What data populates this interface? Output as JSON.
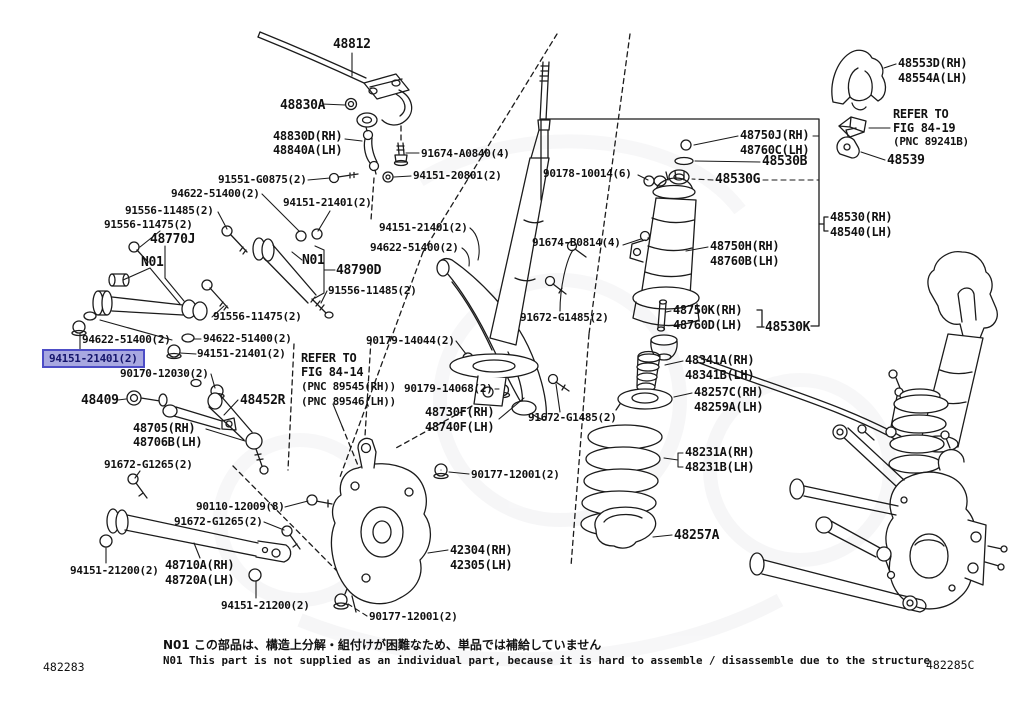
{
  "diagram": {
    "title": "Rear suspension parts diagram",
    "figure_code_left": "482283",
    "figure_code_right": "482285C",
    "note_jp": "N01 この部品は、構造上分解・組付けが困難なため、単品では補給していません",
    "note_en": "N01 This part is not supplied as an individual part, because it is hard to assemble / disassemble due to the structure",
    "selected_part": "94151-21401(2)"
  },
  "colors": {
    "line": "#1b1b1b",
    "highlight_fill": "#a8a8e0",
    "highlight_border": "#4d4dc6",
    "highlight_text": "#15156b"
  },
  "labels": [
    {
      "t": "48812",
      "x": 333,
      "y": 38
    },
    {
      "t": "48830A",
      "x": 280,
      "y": 99
    },
    {
      "t": "48830D(RH)",
      "x": 273,
      "y": 130
    },
    {
      "t": "48840A(LH)",
      "x": 273,
      "y": 144
    },
    {
      "t": "91674-A0840(4)",
      "x": 421,
      "y": 148
    },
    {
      "t": "91551-G0875(2)",
      "x": 218,
      "y": 174
    },
    {
      "t": "94151-20801(2)",
      "x": 413,
      "y": 170
    },
    {
      "t": "94622-51400(2)",
      "x": 171,
      "y": 188
    },
    {
      "t": "94151-21401(2)",
      "x": 283,
      "y": 197
    },
    {
      "t": "91556-11485(2)",
      "x": 125,
      "y": 205
    },
    {
      "t": "91556-11475(2)",
      "x": 104,
      "y": 219
    },
    {
      "t": "48770J",
      "x": 150,
      "y": 233
    },
    {
      "t": "N01",
      "x": 141,
      "y": 256
    },
    {
      "t": "94151-21401(2)",
      "x": 379,
      "y": 222
    },
    {
      "t": "94622-51400(2)",
      "x": 370,
      "y": 242
    },
    {
      "t": "N01",
      "x": 302,
      "y": 254
    },
    {
      "t": "48790D",
      "x": 336,
      "y": 264
    },
    {
      "t": "91556-11485(2)",
      "x": 328,
      "y": 285
    },
    {
      "t": "91556-11475(2)",
      "x": 213,
      "y": 311
    },
    {
      "t": "94622-51400(2)",
      "x": 82,
      "y": 334
    },
    {
      "t": "94151-21401(2)",
      "x": 50,
      "y": 354,
      "hl": true
    },
    {
      "t": "94622-51400(2)",
      "x": 203,
      "y": 333
    },
    {
      "t": "94151-21401(2)",
      "x": 197,
      "y": 348
    },
    {
      "t": "90170-12030(2)",
      "x": 120,
      "y": 368
    },
    {
      "t": "48409",
      "x": 81,
      "y": 394
    },
    {
      "t": "48452R",
      "x": 240,
      "y": 394
    },
    {
      "t": "48705(RH)",
      "x": 133,
      "y": 422
    },
    {
      "t": "48706B(LH)",
      "x": 133,
      "y": 436
    },
    {
      "t": "91672-G1265(2)",
      "x": 104,
      "y": 459
    },
    {
      "t": "90110-12009(8)",
      "x": 196,
      "y": 501
    },
    {
      "t": "91672-G1265(2)",
      "x": 174,
      "y": 516
    },
    {
      "t": "48710A(RH)",
      "x": 165,
      "y": 559
    },
    {
      "t": "48720A(LH)",
      "x": 165,
      "y": 574
    },
    {
      "t": "94151-21200(2)",
      "x": 70,
      "y": 565
    },
    {
      "t": "94151-21200(2)",
      "x": 221,
      "y": 600
    },
    {
      "t": "90177-12001(2)",
      "x": 369,
      "y": 611
    },
    {
      "t": "42304(RH)",
      "x": 450,
      "y": 544
    },
    {
      "t": "42305(LH)",
      "x": 450,
      "y": 559
    },
    {
      "t": "90177-12001(2)",
      "x": 471,
      "y": 469
    },
    {
      "t": "REFER TO",
      "x": 301,
      "y": 352
    },
    {
      "t": "FIG 84-14",
      "x": 301,
      "y": 366
    },
    {
      "t": "(PNC 89545(RH))",
      "x": 301,
      "y": 381
    },
    {
      "t": "(PNC 89546(LH))",
      "x": 301,
      "y": 396
    },
    {
      "t": "90179-14044(2)",
      "x": 366,
      "y": 335
    },
    {
      "t": "90179-14068(2)",
      "x": 404,
      "y": 383
    },
    {
      "t": "48730F(RH)",
      "x": 425,
      "y": 406
    },
    {
      "t": "48740F(LH)",
      "x": 425,
      "y": 421
    },
    {
      "t": "91672-G1485(2)",
      "x": 520,
      "y": 312
    },
    {
      "t": "91672-G1485(2)",
      "x": 528,
      "y": 412
    },
    {
      "t": "91674-B0814(4)",
      "x": 532,
      "y": 237
    },
    {
      "t": "90178-10014(6)",
      "x": 543,
      "y": 168
    },
    {
      "t": "48750J(RH)",
      "x": 740,
      "y": 129
    },
    {
      "t": "48760C(LH)",
      "x": 740,
      "y": 144
    },
    {
      "t": "48530B",
      "x": 762,
      "y": 155
    },
    {
      "t": "48530G",
      "x": 715,
      "y": 173
    },
    {
      "t": "48530(RH)",
      "x": 830,
      "y": 211
    },
    {
      "t": "48540(LH)",
      "x": 830,
      "y": 226
    },
    {
      "t": "48750H(RH)",
      "x": 710,
      "y": 240
    },
    {
      "t": "48760B(LH)",
      "x": 710,
      "y": 255
    },
    {
      "t": "48750K(RH)",
      "x": 673,
      "y": 304
    },
    {
      "t": "48760D(LH)",
      "x": 673,
      "y": 319
    },
    {
      "t": "48530K",
      "x": 765,
      "y": 321
    },
    {
      "t": "48341A(RH)",
      "x": 685,
      "y": 354
    },
    {
      "t": "48341B(LH)",
      "x": 685,
      "y": 369
    },
    {
      "t": "48257C(RH)",
      "x": 694,
      "y": 386
    },
    {
      "t": "48259A(LH)",
      "x": 694,
      "y": 401
    },
    {
      "t": "48231A(RH)",
      "x": 685,
      "y": 446
    },
    {
      "t": "48231B(LH)",
      "x": 685,
      "y": 461
    },
    {
      "t": "48257A",
      "x": 674,
      "y": 529
    },
    {
      "t": "48553D(RH)",
      "x": 898,
      "y": 57
    },
    {
      "t": "48554A(LH)",
      "x": 898,
      "y": 72
    },
    {
      "t": "REFER TO",
      "x": 893,
      "y": 108
    },
    {
      "t": "FIG 84-19",
      "x": 893,
      "y": 122
    },
    {
      "t": "(PNC 89241B)",
      "x": 893,
      "y": 136
    },
    {
      "t": "48539",
      "x": 887,
      "y": 154
    }
  ]
}
